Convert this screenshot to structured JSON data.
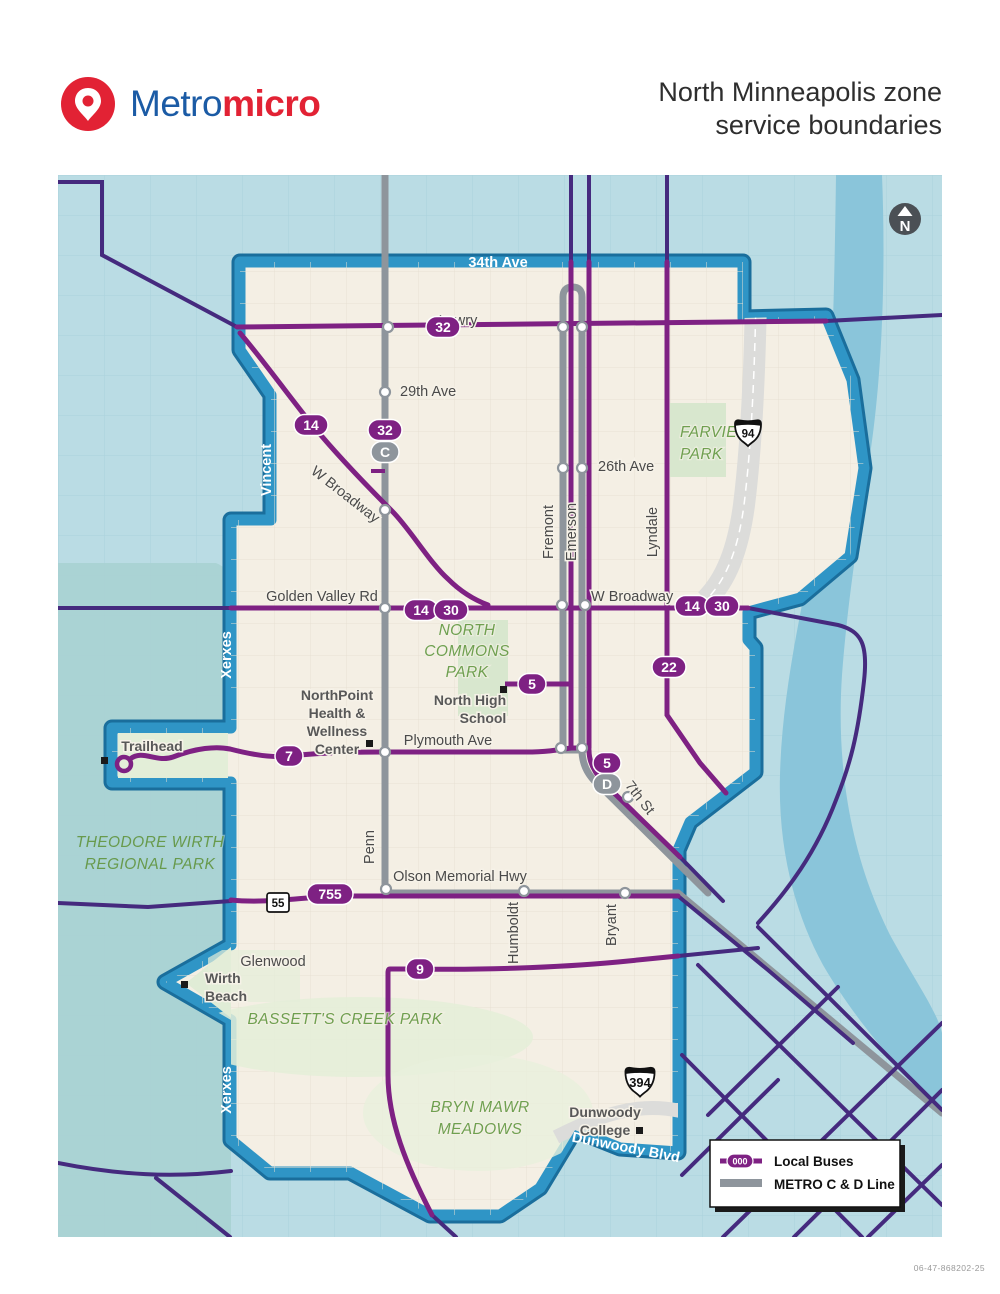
{
  "header": {
    "logo": {
      "brand_metro": "Metro",
      "brand_micro": "micro"
    },
    "title": {
      "line1": "North Minneapolis zone",
      "line2": "service boundaries"
    }
  },
  "map": {
    "north_label": "N",
    "boundary_labels": {
      "top_street": "34th Ave",
      "bottom_street": "Dunwoody Blvd",
      "vincent": "Vincent",
      "xerxes_upper": "Xerxes",
      "xerxes_lower": "Xerxes"
    },
    "streets": {
      "lowry": "Lowry",
      "ave29": "29th Ave",
      "ave26": "26th Ave",
      "w_broadway_nw": "W Broadway",
      "w_broadway_e": "W Broadway",
      "golden_valley": "Golden Valley Rd",
      "plymouth": "Plymouth Ave",
      "seventh": "7th St",
      "olson": "Olson Memorial Hwy",
      "glenwood": "Glenwood",
      "fremont": "Fremont",
      "emerson": "Emerson",
      "lyndale": "Lyndale",
      "penn": "Penn",
      "humboldt": "Humboldt",
      "bryant": "Bryant"
    },
    "parks": {
      "farview": [
        "FARVIEW",
        "PARK"
      ],
      "north_commons": [
        "NORTH",
        "COMMONS",
        "PARK"
      ],
      "theodore_wirth": [
        "THEODORE WIRTH",
        "REGIONAL PARK"
      ],
      "bassetts": "BASSETT'S CREEK  PARK",
      "bryn_mawr": [
        "BRYN MAWR",
        "MEADOWS"
      ]
    },
    "pois": {
      "northpoint": [
        "NorthPoint",
        "Health &",
        "Wellness",
        "Center"
      ],
      "north_high": [
        "North High",
        "School"
      ],
      "trailhead": "Trailhead",
      "wirth_beach": [
        "Wirth",
        "Beach"
      ],
      "dunwoody": [
        "Dunwoody",
        "College"
      ]
    },
    "badges": {
      "b32_lowry": "32",
      "b14_broadway": "14",
      "b32_penn": "32",
      "bC": "C",
      "b14_gv": "14",
      "b30_gv": "30",
      "b14_e": "14",
      "b30_e": "30",
      "b22": "22",
      "b5_school": "5",
      "b5_plym": "5",
      "bD": "D",
      "b7": "7",
      "b755": "755",
      "b9": "9"
    },
    "shields": {
      "i94": "94",
      "mn55": "55",
      "i394": "394"
    }
  },
  "legend": {
    "local_buses": {
      "badge": "000",
      "label": "Local Buses"
    },
    "metro": {
      "label": "METRO C & D Line"
    }
  },
  "footer": {
    "code": "06-47-868202-25"
  }
}
